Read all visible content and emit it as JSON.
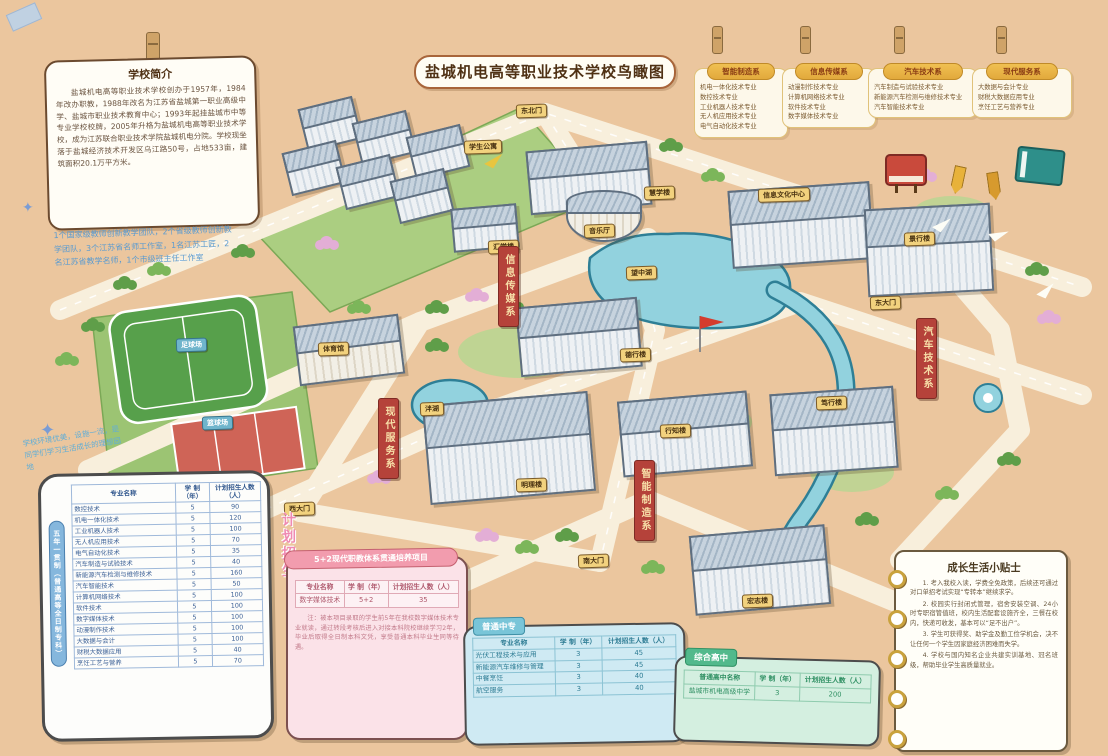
{
  "title": "盐城机电高等职业技术学校鸟瞰图",
  "colors": {
    "background": "#ebc69e",
    "ribbon_red": "#b5423a",
    "plaque_yellow": "#f2d27e",
    "water_blue": "#92d2de",
    "five_year_blue": "#85b7dd",
    "bridge_pink": "#f29cae",
    "secondary_cyan": "#79c5d8",
    "comprehensive_green": "#52b98c"
  },
  "intro": {
    "title": "学校简介",
    "body": "盐城机电高等职业技术学校创办于1957年，1984年改办职教，1988年改名为江苏省盐城第一职业高级中学、盐城市职业技术教育中心；1993年起挂盐城市中等专业学校校牌，2005年升格为盐城机电高等职业技术学校，成为江苏联合职业技术学院盐城机电分院。学校现坐落于盐城经济技术开发区乌江路50号，占地533亩，建筑面积20.1万平方米。"
  },
  "faculty_note": "1个国家级教师创新教学团队，2个省级教师创新教学团队，3个江苏省名师工作室，1名江苏工匠，2名江苏省教学名师，1个市级班主任工作室",
  "campus_note": "学校环境优美，设施一流，是同学们学习生活成长的理想园地",
  "plan_label": "计划招生",
  "departments": [
    {
      "name": "智能制造系",
      "majors": [
        "机电一体化技术专业",
        "数控技术专业",
        "工业机器人技术专业",
        "无人机应用技术专业",
        "电气自动化技术专业"
      ]
    },
    {
      "name": "信息传媒系",
      "majors": [
        "动漫制作技术专业",
        "计算机网络技术专业",
        "软件技术专业",
        "数字媒体技术专业"
      ]
    },
    {
      "name": "汽车技术系",
      "majors": [
        "汽车制造与试验技术专业",
        "新能源汽车检测与维修技术专业",
        "汽车智能技术专业"
      ]
    },
    {
      "name": "现代服务系",
      "majors": [
        "大数据与会计专业",
        "财税大数据应用专业",
        "烹饪工艺与营养专业"
      ]
    }
  ],
  "map": {
    "ribbons": [
      "信息传媒系",
      "现代服务系",
      "智能制造系",
      "汽车技术系"
    ],
    "gates": [
      "东北门",
      "东大门",
      "西大门",
      "南大门"
    ],
    "buildings": [
      "学生公寓",
      "汇学楼",
      "慧学楼",
      "音乐厅",
      "信息文化中心",
      "景行楼",
      "体育馆",
      "德行楼",
      "行知楼",
      "明理楼",
      "笃行楼",
      "宏志楼"
    ],
    "water": [
      "望中湖",
      "泮湖"
    ],
    "sports": [
      "足球场",
      "篮球场"
    ]
  },
  "tables": {
    "five_year": {
      "side_label": "五年一贯制（普通高等全日制专科）",
      "headers": [
        "专业名称",
        "学 制（年）",
        "计划招生人数（人）"
      ],
      "rows": [
        [
          "数控技术",
          "5",
          "90"
        ],
        [
          "机电一体化技术",
          "5",
          "120"
        ],
        [
          "工业机器人技术",
          "5",
          "100"
        ],
        [
          "无人机应用技术",
          "5",
          "70"
        ],
        [
          "电气自动化技术",
          "5",
          "35"
        ],
        [
          "汽车制造与试验技术",
          "5",
          "40"
        ],
        [
          "新能源汽车检测与维修技术",
          "5",
          "160"
        ],
        [
          "汽车智能技术",
          "5",
          "50"
        ],
        [
          "计算机网络技术",
          "5",
          "100"
        ],
        [
          "软件技术",
          "5",
          "100"
        ],
        [
          "数字媒体技术",
          "5",
          "100"
        ],
        [
          "动漫制作技术",
          "5",
          "100"
        ],
        [
          "大数据与会计",
          "5",
          "100"
        ],
        [
          "财税大数据应用",
          "5",
          "40"
        ],
        [
          "烹饪工艺与营养",
          "5",
          "70"
        ]
      ]
    },
    "bridge": {
      "title": "5+2现代职教体系贯通培养项目",
      "headers": [
        "专业名称",
        "学 制（年）",
        "计划招生人数（人）"
      ],
      "rows": [
        [
          "数字媒体技术",
          "5+2",
          "35"
        ]
      ],
      "note": "注：被本项目录取的学生前5年在我校数字媒体技术专业就读，通过转段考核后进入对接本科院校继续学习2年，毕业后取得全日制本科文凭，享受普通本科毕业生同等待遇。"
    },
    "secondary": {
      "tag": "普通中专",
      "headers": [
        "专业名称",
        "学 制（年）",
        "计划招生人数（人）"
      ],
      "rows": [
        [
          "光伏工程技术与应用",
          "3",
          "45"
        ],
        [
          "新能源汽车维修与管理",
          "3",
          "45"
        ],
        [
          "中餐烹饪",
          "3",
          "40"
        ],
        [
          "航空服务",
          "3",
          "40"
        ]
      ]
    },
    "comprehensive": {
      "tag": "综合高中",
      "headers": [
        "普通高中名称",
        "学 制（年）",
        "计划招生人数（人）"
      ],
      "rows": [
        [
          "盐城市机电高级中学",
          "3",
          "200"
        ]
      ]
    }
  },
  "tips": {
    "title": "成长生活小贴士",
    "items": [
      "1. 考入我校入读，学费全免政策，后续还可通过对口单招考试实现“专转本”继续求学。",
      "2. 校园实行封闭式管理，宿舍安装空调、24小时专职宿管值班，校内生活配套设施齐全，三餐在校内，快递可收发，基本可以“足不出户”。",
      "3. 学生可获得奖、助学金及勤工俭学机会，决不让任何一个学生因家庭经济困难而失学。",
      "4. 学校与国内知名企业共建实训基地、冠名班级，帮助毕业学生高质量就业。"
    ]
  }
}
